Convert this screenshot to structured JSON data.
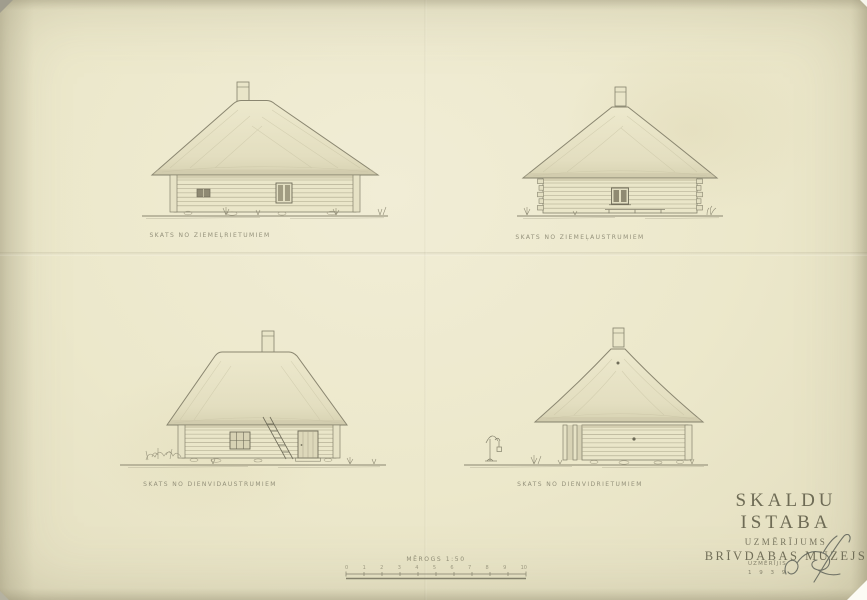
{
  "title_block": {
    "title": "SKALDU ISTABA",
    "subtitle": "UZMĒRĪJUMS",
    "institution": "BRĪVDABAS MUZEJS"
  },
  "elevations": [
    {
      "caption": "SKATS NO ZIEMEĻRIETUMIEM"
    },
    {
      "caption": "SKATS NO ZIEMEĻAUSTRUMIEM"
    },
    {
      "caption": "SKATS NO DIENVIDAUSTRUMIEM"
    },
    {
      "caption": "SKATS NO DIENVIDRIETUMIEM"
    }
  ],
  "scale": {
    "label": "MĒROGS  1:50",
    "ticks": [
      "0",
      "1",
      "2",
      "3",
      "4",
      "5",
      "6",
      "7",
      "8",
      "9",
      "10"
    ]
  },
  "credits": {
    "measured_by_label": "UZMĒRĪJIS",
    "year": "1 9 3 9"
  },
  "colors": {
    "paper": "#ece8cb",
    "pencil": "#84816c",
    "lettering": "#6b6853"
  }
}
